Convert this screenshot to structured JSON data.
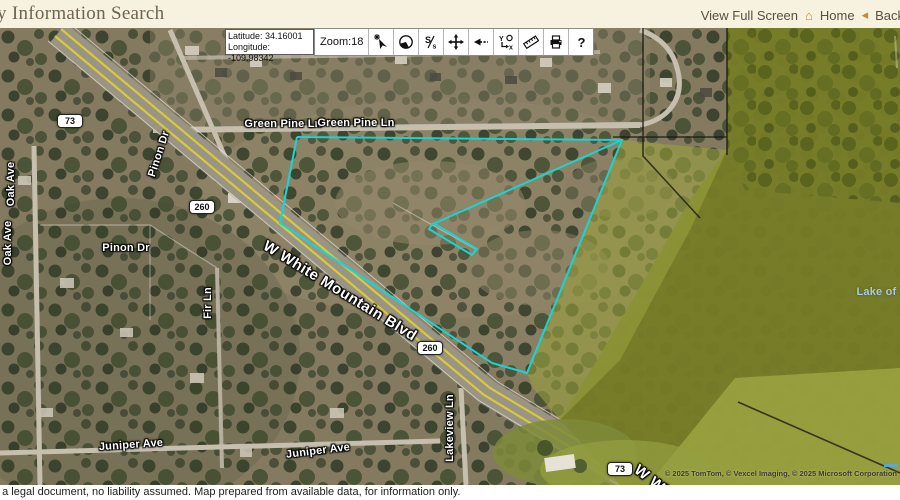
{
  "header": {
    "title": "y Information Search",
    "links": {
      "view_full_screen": "View Full Screen",
      "home": "Home",
      "back": "Back"
    }
  },
  "toolbar": {
    "latitude": "Latitude: 34.16001",
    "longitude": "Longitude: -109.98342",
    "zoom": "Zoom:18",
    "icons": [
      {
        "name": "identify-pointer-icon"
      },
      {
        "name": "overview-map-icon"
      },
      {
        "name": "scale-icon"
      },
      {
        "name": "pan-icon"
      },
      {
        "name": "previous-extent-icon"
      },
      {
        "name": "coordinates-icon"
      },
      {
        "name": "measure-icon"
      },
      {
        "name": "print-icon"
      },
      {
        "name": "help-icon"
      }
    ]
  },
  "map": {
    "street_labels": [
      {
        "slug": "green-pine-ln-1",
        "text": "Green Pine Ln",
        "x": 283,
        "y": 96,
        "rot": 0
      },
      {
        "slug": "green-pine-ln-2",
        "text": "Green Pine Ln",
        "x": 356,
        "y": 95,
        "rot": 0
      },
      {
        "slug": "pinon-dr-vertical",
        "text": "Pinon Dr",
        "x": 159,
        "y": 126,
        "rot": -72
      },
      {
        "slug": "oak-ave-1",
        "text": "Oak Ave",
        "x": 11,
        "y": 156,
        "rot": -90
      },
      {
        "slug": "oak-ave-2",
        "text": "Oak Ave",
        "x": 8,
        "y": 215,
        "rot": -90
      },
      {
        "slug": "pinon-dr-horizontal",
        "text": "Pinon Dr",
        "x": 126,
        "y": 220,
        "rot": 0
      },
      {
        "slug": "fir-ln",
        "text": "Fir Ln",
        "x": 208,
        "y": 275,
        "rot": -90
      },
      {
        "slug": "w-white-mountain-blvd",
        "text": "W White Mountain Blvd",
        "x": 340,
        "y": 263,
        "rot": 31.5,
        "big": true
      },
      {
        "slug": "juniper-ave-1",
        "text": "Juniper Ave",
        "x": 131,
        "y": 417,
        "rot": -4
      },
      {
        "slug": "juniper-ave-2",
        "text": "Juniper Ave",
        "x": 318,
        "y": 423,
        "rot": -7
      },
      {
        "slug": "lakeview-ln",
        "text": "Lakeview Ln",
        "x": 450,
        "y": 400,
        "rot": -90
      },
      {
        "slug": "w-white-mountain-blvd-south",
        "text": "W Whi",
        "x": 655,
        "y": 455,
        "rot": 38,
        "big": true
      },
      {
        "slug": "lake-of-the-woods",
        "text": "Lake of t",
        "x": 880,
        "y": 264,
        "rot": 0,
        "water": true
      }
    ],
    "route_shields": [
      {
        "slug": "route-73-north",
        "text": "73",
        "x": 70,
        "y": 93
      },
      {
        "slug": "route-260-west",
        "text": "260",
        "x": 202,
        "y": 179
      },
      {
        "slug": "route-260-south",
        "text": "260",
        "x": 430,
        "y": 320
      },
      {
        "slug": "route-73-south",
        "text": "73",
        "x": 620,
        "y": 441
      }
    ],
    "parcel": {
      "color": "#14d6d6",
      "outer": [
        [
          297,
          109
        ],
        [
          622,
          112
        ],
        [
          527,
          345
        ],
        [
          492,
          335
        ],
        [
          280,
          195
        ]
      ],
      "interior_line": [
        [
          622,
          112
        ],
        [
          433,
          196
        ]
      ],
      "sliver": [
        [
          433,
          195
        ],
        [
          477,
          221
        ],
        [
          472,
          227
        ],
        [
          429,
          201
        ]
      ]
    },
    "copyright": "© 2025 TomTom, © Vexcel Imaging, © 2025 Microsoft Corporation"
  },
  "footer": {
    "disclaimer": "t a legal document, no liability assumed. Map prepared from available data, for information only."
  },
  "colors": {
    "header_bg": "#f7f1df",
    "title_text": "#6d6450",
    "link_text": "#57503f",
    "accent_orange": "#c9882a",
    "parcel_cyan": "#14d6d6",
    "lake_olive": "#767c26"
  }
}
